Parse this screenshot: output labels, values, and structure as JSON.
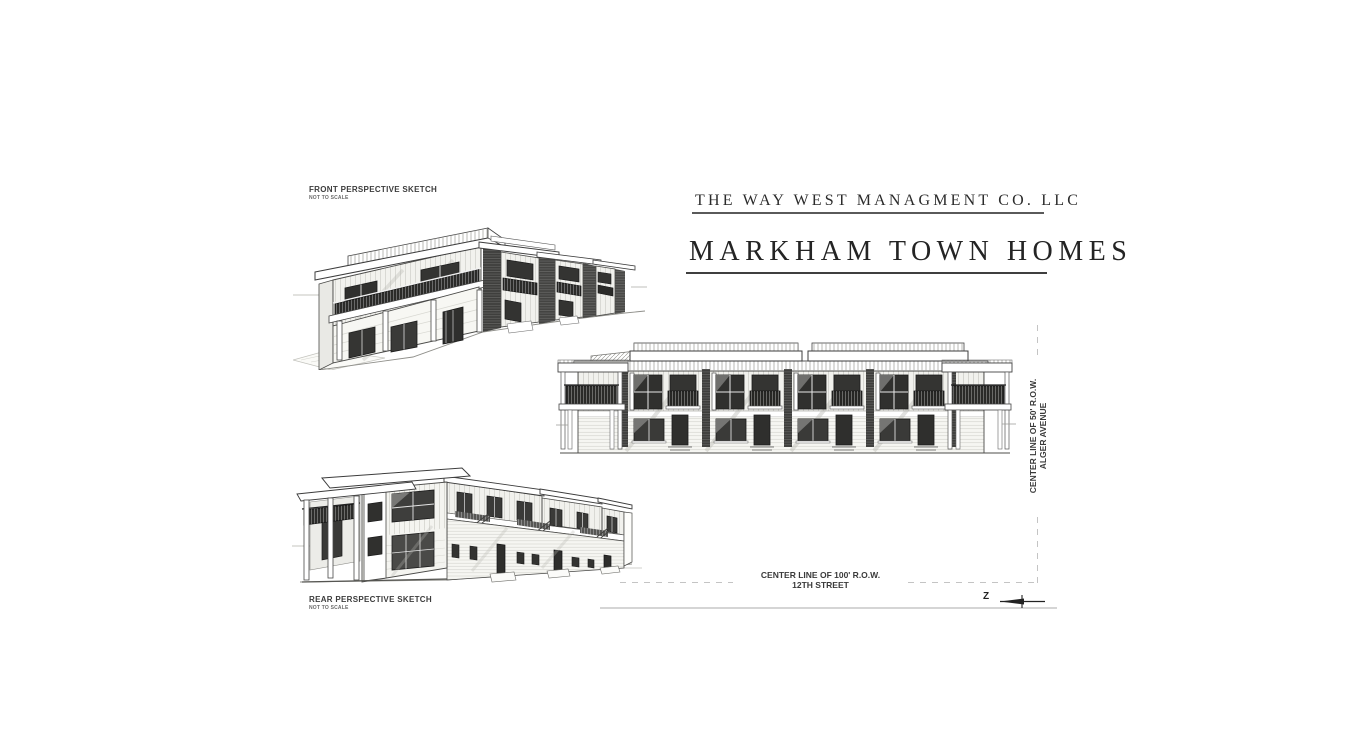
{
  "title_block": {
    "company_name": "THE WAY WEST MANAGMENT CO. LLC",
    "project_name": "MARKHAM TOWN HOMES"
  },
  "sketch_labels": {
    "front": {
      "title": "FRONT PERSPECTIVE SKETCH",
      "scale_note": "NOT TO SCALE"
    },
    "rear": {
      "title": "REAR PERSPECTIVE SKETCH",
      "scale_note": "NOT TO SCALE"
    }
  },
  "site_annotations": {
    "street_south": {
      "line1": "CENTER LINE OF 100' R.O.W.",
      "line2": "12TH STREET"
    },
    "street_east": {
      "line1": "CENTER LINE OF 50' R.O.W.",
      "line2": "ALGER AVENUE"
    },
    "north_arrow_label": "Z",
    "north_arrow_icon": "north-arrow-icon"
  },
  "colors": {
    "paper": "#ffffff",
    "ink": "#3a3a3a",
    "dashed_centerline": "#c4c4c4",
    "window_glass": "#30302e"
  }
}
